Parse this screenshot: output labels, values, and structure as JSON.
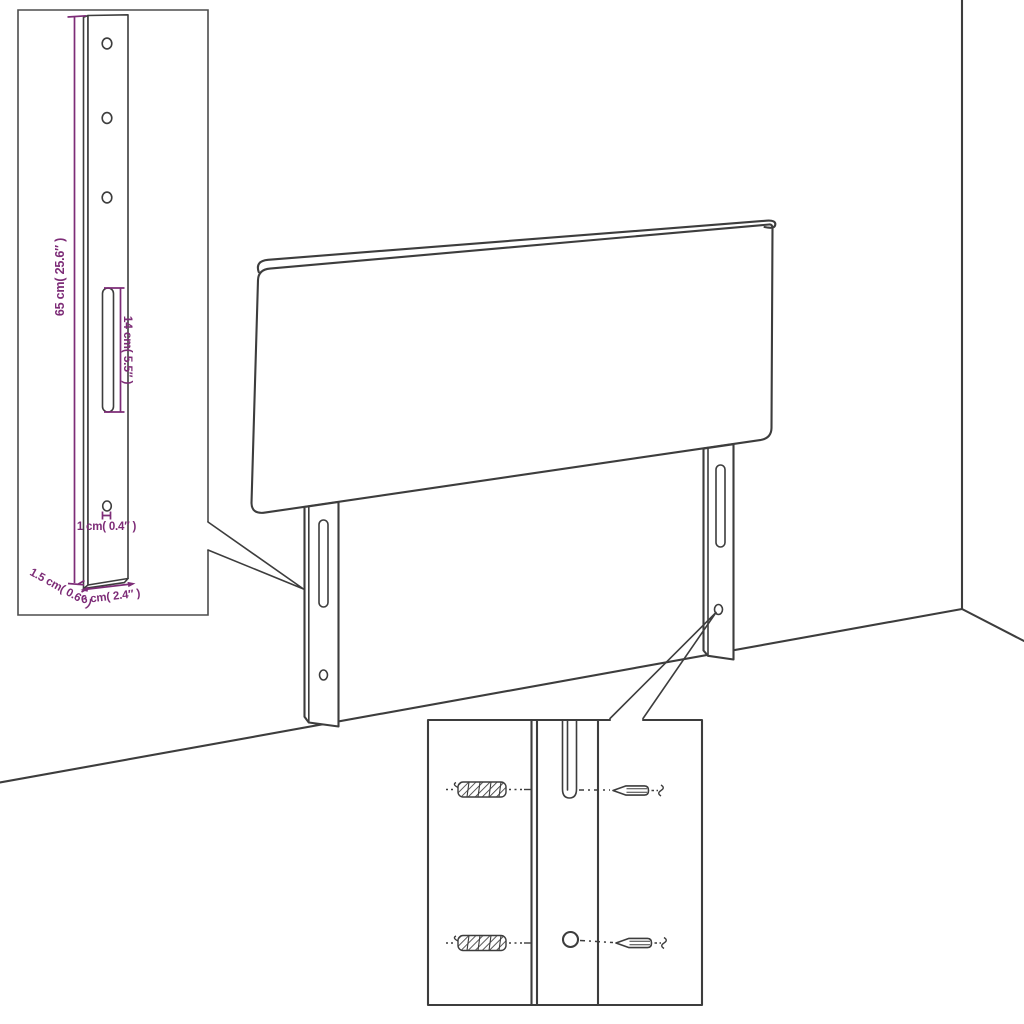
{
  "colors": {
    "outline": "#3d3d3d",
    "dimension": "#7d2c77",
    "background": "#ffffff"
  },
  "detail_callout": {
    "labels": {
      "height": "65 cm( 25.6″ )",
      "slot": "14 cm( 5.5″ )",
      "hole": "1 cm( 0.4″ )",
      "depth": "1.5 cm( 0.6″ )",
      "width": "6 cm( 2.4″ )"
    },
    "hole_count": 3
  },
  "hardware_inset": {
    "anchor_count": 2,
    "screw_count": 2
  },
  "legs": {
    "count": 2
  }
}
